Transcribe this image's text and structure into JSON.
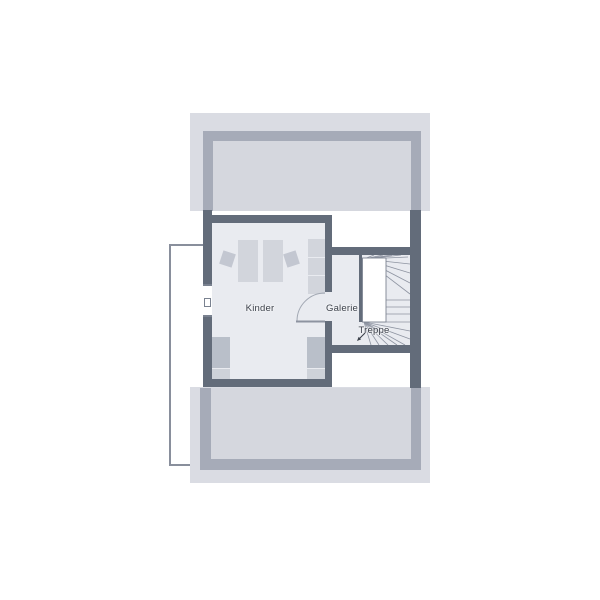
{
  "plan_type": "floor-plan-upper-storey",
  "rooms": {
    "kinder": "Kinder",
    "galerie": "Galerie",
    "treppe": "Treppe"
  },
  "colors": {
    "background": "#ffffff",
    "wall": "#636c7a",
    "wall_band": "#a6abb8",
    "roof": "#dadce3",
    "roof_inner": "#d5d7de",
    "floor": "#e9ebf0",
    "furniture": "#d2d5dc",
    "furniture_mid": "#c3c7d1",
    "furniture_dark": "#b9bfc9",
    "bed_foot": "#ced2d9",
    "stair_line": "#8e94a1",
    "void_border": "#7c8391",
    "door_arc": "#a2a8b3",
    "door_leaf": "#8d93a0",
    "balcony": "#898f9c",
    "window_frame": "#7a8290",
    "text": "#3b404a"
  }
}
